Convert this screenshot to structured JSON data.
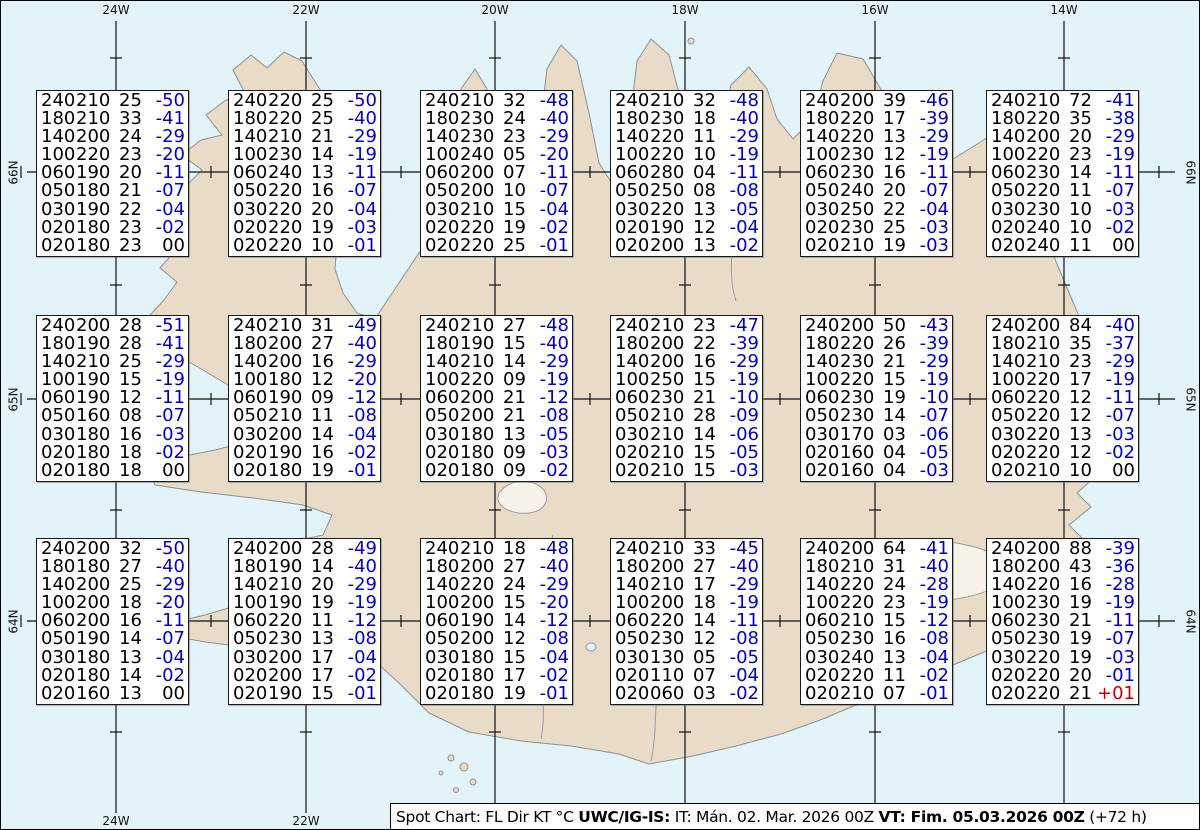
{
  "map": {
    "meridian_labels": [
      "24W",
      "22W",
      "20W",
      "18W",
      "16W",
      "14W"
    ],
    "bottom_meridian_labels": [
      "24W",
      "22W"
    ],
    "latitude_labels": [
      "66N",
      "65N",
      "64N"
    ]
  },
  "colors": {
    "temp_negative": "#0000cc",
    "temp_positive": "#cc0000",
    "temp_zero": "#000000",
    "water": "#e2f4fa",
    "land": "#e8dcc9"
  },
  "legend": {
    "columns": [
      "FL",
      "Dir",
      "KT",
      "°C"
    ]
  },
  "spot_boxes": [
    {
      "rows": [
        [
          "240210",
          "25",
          "-50"
        ],
        [
          "180210",
          "33",
          "-41"
        ],
        [
          "140200",
          "24",
          "-29"
        ],
        [
          "100220",
          "23",
          "-20"
        ],
        [
          "060190",
          "20",
          "-11"
        ],
        [
          "050180",
          "21",
          "-07"
        ],
        [
          "030190",
          "22",
          "-04"
        ],
        [
          "020180",
          "23",
          "-02"
        ],
        [
          "020180",
          "23",
          "00"
        ]
      ]
    },
    {
      "rows": [
        [
          "240220",
          "25",
          "-50"
        ],
        [
          "180220",
          "25",
          "-40"
        ],
        [
          "140210",
          "21",
          "-29"
        ],
        [
          "100230",
          "14",
          "-19"
        ],
        [
          "060240",
          "13",
          "-11"
        ],
        [
          "050220",
          "16",
          "-07"
        ],
        [
          "030220",
          "20",
          "-04"
        ],
        [
          "020220",
          "19",
          "-03"
        ],
        [
          "020220",
          "10",
          "-01"
        ]
      ]
    },
    {
      "rows": [
        [
          "240210",
          "32",
          "-48"
        ],
        [
          "180230",
          "24",
          "-40"
        ],
        [
          "140230",
          "23",
          "-29"
        ],
        [
          "100240",
          "05",
          "-20"
        ],
        [
          "060200",
          "07",
          "-11"
        ],
        [
          "050200",
          "10",
          "-07"
        ],
        [
          "030210",
          "15",
          "-04"
        ],
        [
          "020220",
          "19",
          "-02"
        ],
        [
          "020220",
          "25",
          "-01"
        ]
      ]
    },
    {
      "rows": [
        [
          "240210",
          "32",
          "-48"
        ],
        [
          "180230",
          "18",
          "-40"
        ],
        [
          "140220",
          "11",
          "-29"
        ],
        [
          "100220",
          "10",
          "-19"
        ],
        [
          "060280",
          "04",
          "-11"
        ],
        [
          "050250",
          "08",
          "-08"
        ],
        [
          "030220",
          "13",
          "-05"
        ],
        [
          "020190",
          "12",
          "-04"
        ],
        [
          "020200",
          "13",
          "-02"
        ]
      ]
    },
    {
      "rows": [
        [
          "240200",
          "39",
          "-46"
        ],
        [
          "180220",
          "17",
          "-39"
        ],
        [
          "140220",
          "13",
          "-29"
        ],
        [
          "100230",
          "12",
          "-19"
        ],
        [
          "060230",
          "16",
          "-11"
        ],
        [
          "050240",
          "20",
          "-07"
        ],
        [
          "030250",
          "22",
          "-04"
        ],
        [
          "020230",
          "25",
          "-03"
        ],
        [
          "020210",
          "19",
          "-03"
        ]
      ]
    },
    {
      "rows": [
        [
          "240210",
          "72",
          "-41"
        ],
        [
          "180220",
          "35",
          "-38"
        ],
        [
          "140200",
          "20",
          "-29"
        ],
        [
          "100220",
          "23",
          "-19"
        ],
        [
          "060230",
          "14",
          "-11"
        ],
        [
          "050220",
          "11",
          "-07"
        ],
        [
          "030230",
          "10",
          "-03"
        ],
        [
          "020240",
          "10",
          "-02"
        ],
        [
          "020240",
          "11",
          "00"
        ]
      ]
    },
    {
      "rows": [
        [
          "240200",
          "28",
          "-51"
        ],
        [
          "180190",
          "28",
          "-41"
        ],
        [
          "140210",
          "25",
          "-29"
        ],
        [
          "100190",
          "15",
          "-19"
        ],
        [
          "060190",
          "12",
          "-11"
        ],
        [
          "050160",
          "08",
          "-07"
        ],
        [
          "030180",
          "16",
          "-03"
        ],
        [
          "020180",
          "18",
          "-02"
        ],
        [
          "020180",
          "18",
          "00"
        ]
      ]
    },
    {
      "rows": [
        [
          "240210",
          "31",
          "-49"
        ],
        [
          "180200",
          "27",
          "-40"
        ],
        [
          "140200",
          "16",
          "-29"
        ],
        [
          "100180",
          "12",
          "-20"
        ],
        [
          "060190",
          "09",
          "-12"
        ],
        [
          "050210",
          "11",
          "-08"
        ],
        [
          "030200",
          "14",
          "-04"
        ],
        [
          "020190",
          "16",
          "-02"
        ],
        [
          "020180",
          "19",
          "-01"
        ]
      ]
    },
    {
      "rows": [
        [
          "240210",
          "27",
          "-48"
        ],
        [
          "180190",
          "15",
          "-40"
        ],
        [
          "140210",
          "14",
          "-29"
        ],
        [
          "100220",
          "09",
          "-19"
        ],
        [
          "060200",
          "21",
          "-12"
        ],
        [
          "050200",
          "21",
          "-08"
        ],
        [
          "030180",
          "13",
          "-05"
        ],
        [
          "020180",
          "09",
          "-03"
        ],
        [
          "020180",
          "09",
          "-02"
        ]
      ]
    },
    {
      "rows": [
        [
          "240210",
          "23",
          "-47"
        ],
        [
          "180200",
          "22",
          "-39"
        ],
        [
          "140200",
          "16",
          "-29"
        ],
        [
          "100250",
          "15",
          "-19"
        ],
        [
          "060230",
          "21",
          "-10"
        ],
        [
          "050210",
          "28",
          "-09"
        ],
        [
          "030210",
          "14",
          "-06"
        ],
        [
          "020210",
          "15",
          "-05"
        ],
        [
          "020210",
          "15",
          "-03"
        ]
      ]
    },
    {
      "rows": [
        [
          "240200",
          "50",
          "-43"
        ],
        [
          "180220",
          "26",
          "-39"
        ],
        [
          "140230",
          "21",
          "-29"
        ],
        [
          "100220",
          "15",
          "-19"
        ],
        [
          "060230",
          "19",
          "-10"
        ],
        [
          "050230",
          "14",
          "-07"
        ],
        [
          "030170",
          "03",
          "-06"
        ],
        [
          "020160",
          "04",
          "-05"
        ],
        [
          "020160",
          "04",
          "-03"
        ]
      ]
    },
    {
      "rows": [
        [
          "240200",
          "84",
          "-40"
        ],
        [
          "180210",
          "35",
          "-37"
        ],
        [
          "140210",
          "23",
          "-29"
        ],
        [
          "100220",
          "17",
          "-19"
        ],
        [
          "060220",
          "12",
          "-11"
        ],
        [
          "050220",
          "12",
          "-07"
        ],
        [
          "030220",
          "13",
          "-03"
        ],
        [
          "020220",
          "12",
          "-02"
        ],
        [
          "020210",
          "10",
          "00"
        ]
      ]
    },
    {
      "rows": [
        [
          "240200",
          "32",
          "-50"
        ],
        [
          "180180",
          "27",
          "-40"
        ],
        [
          "140200",
          "25",
          "-29"
        ],
        [
          "100200",
          "18",
          "-20"
        ],
        [
          "060200",
          "16",
          "-11"
        ],
        [
          "050190",
          "14",
          "-07"
        ],
        [
          "030180",
          "13",
          "-04"
        ],
        [
          "020180",
          "14",
          "-02"
        ],
        [
          "020160",
          "13",
          "00"
        ]
      ]
    },
    {
      "rows": [
        [
          "240200",
          "28",
          "-49"
        ],
        [
          "180190",
          "14",
          "-40"
        ],
        [
          "140210",
          "20",
          "-29"
        ],
        [
          "100190",
          "19",
          "-19"
        ],
        [
          "060220",
          "11",
          "-12"
        ],
        [
          "050230",
          "13",
          "-08"
        ],
        [
          "030200",
          "17",
          "-04"
        ],
        [
          "020200",
          "17",
          "-02"
        ],
        [
          "020190",
          "15",
          "-01"
        ]
      ]
    },
    {
      "rows": [
        [
          "240210",
          "18",
          "-48"
        ],
        [
          "180200",
          "27",
          "-40"
        ],
        [
          "140220",
          "24",
          "-29"
        ],
        [
          "100200",
          "15",
          "-20"
        ],
        [
          "060190",
          "14",
          "-12"
        ],
        [
          "050200",
          "12",
          "-08"
        ],
        [
          "030180",
          "15",
          "-04"
        ],
        [
          "020180",
          "17",
          "-02"
        ],
        [
          "020180",
          "19",
          "-01"
        ]
      ]
    },
    {
      "rows": [
        [
          "240210",
          "33",
          "-45"
        ],
        [
          "180200",
          "27",
          "-40"
        ],
        [
          "140210",
          "17",
          "-29"
        ],
        [
          "100200",
          "18",
          "-19"
        ],
        [
          "060220",
          "14",
          "-11"
        ],
        [
          "050230",
          "12",
          "-08"
        ],
        [
          "030130",
          "05",
          "-05"
        ],
        [
          "020110",
          "07",
          "-04"
        ],
        [
          "020060",
          "03",
          "-02"
        ]
      ]
    },
    {
      "rows": [
        [
          "240200",
          "64",
          "-41"
        ],
        [
          "180210",
          "31",
          "-40"
        ],
        [
          "140220",
          "24",
          "-28"
        ],
        [
          "100220",
          "23",
          "-19"
        ],
        [
          "060210",
          "15",
          "-12"
        ],
        [
          "050230",
          "16",
          "-08"
        ],
        [
          "030240",
          "13",
          "-04"
        ],
        [
          "020220",
          "11",
          "-02"
        ],
        [
          "020210",
          "07",
          "-01"
        ]
      ]
    },
    {
      "rows": [
        [
          "240200",
          "88",
          "-39"
        ],
        [
          "180200",
          "43",
          "-36"
        ],
        [
          "140220",
          "16",
          "-28"
        ],
        [
          "100230",
          "19",
          "-19"
        ],
        [
          "060230",
          "21",
          "-11"
        ],
        [
          "050230",
          "19",
          "-07"
        ],
        [
          "030220",
          "19",
          "-03"
        ],
        [
          "020220",
          "20",
          "-01"
        ],
        [
          "020220",
          "21",
          "+01"
        ]
      ]
    }
  ],
  "footer": {
    "segments": [
      {
        "text": "Spot Chart: FL Dir KT °C ",
        "bold": false
      },
      {
        "text": "UWC/IG-IS:",
        "bold": true
      },
      {
        "text": " IT: Mán. 02. Mar. 2026 00Z ",
        "bold": false
      },
      {
        "text": "VT: Fim. 05.03.2026 00Z",
        "bold": true
      },
      {
        "text": " (+72 h)",
        "bold": false
      }
    ]
  }
}
